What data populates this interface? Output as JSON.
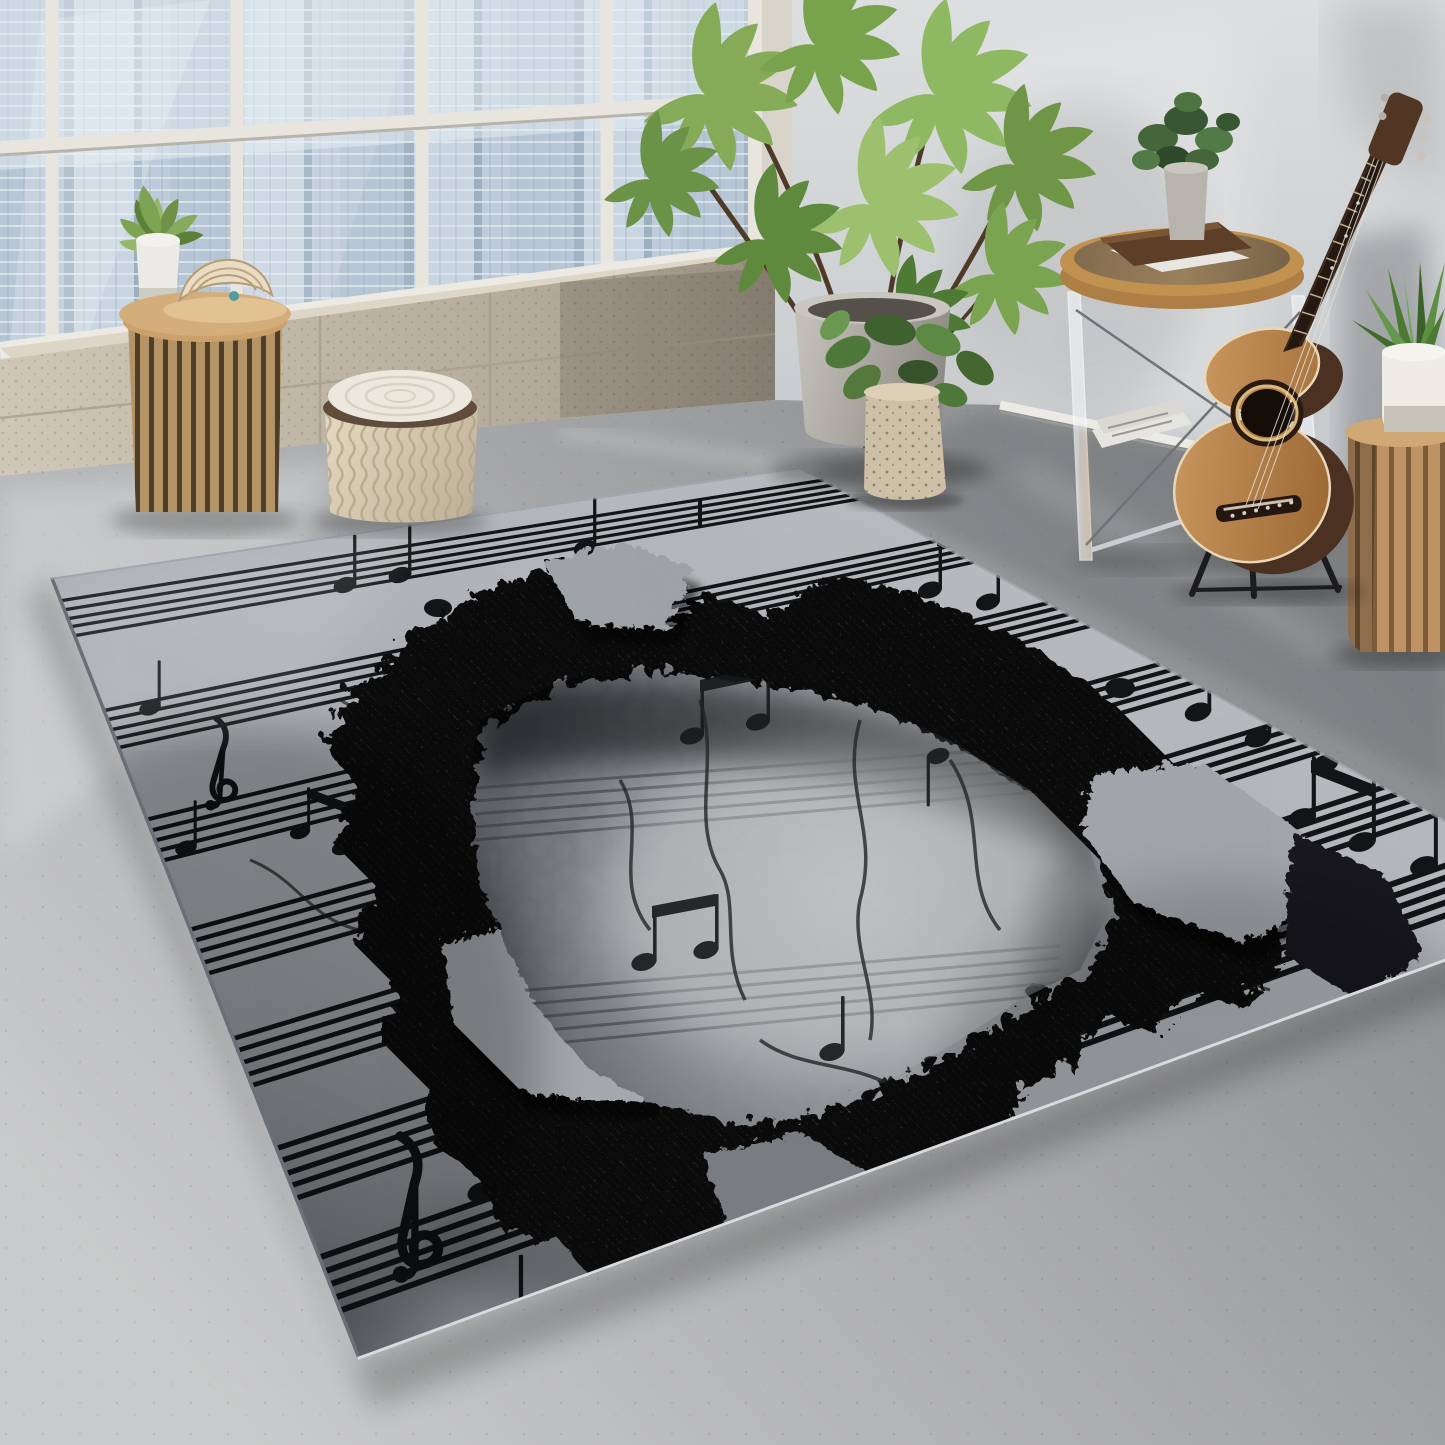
{
  "meta": {
    "description": "Interior photograph: loft room with large city-view window, concrete floor, and a black-and-grey 3D optical-illusion rug printed with sheet music and a cracked crater hole; acoustic guitar on a stand, plants, rattan side table, woven pouf, round glass-leg side table with books, wood slat stool.",
    "image_width": 1445,
    "image_height": 1445
  },
  "scene": {
    "objects": [
      {
        "id": "window-city-view",
        "label": "large paned window with city skyline"
      },
      {
        "id": "concrete-ledge",
        "label": "concrete block window ledge"
      },
      {
        "id": "windowsill-plant",
        "label": "small potted plant in white pot"
      },
      {
        "id": "rattan-side-table",
        "label": "rattan slatted side table"
      },
      {
        "id": "decor-sculpture",
        "label": "folded shell sculpture on wood slice"
      },
      {
        "id": "woven-pouf",
        "label": "cream woven pouf with cushion top"
      },
      {
        "id": "large-potted-plant",
        "label": "tall green plant in concrete pot"
      },
      {
        "id": "speckled-vase-plant",
        "label": "plant in speckled ceramic vase"
      },
      {
        "id": "console-table",
        "label": "round wood-top table with clear legs"
      },
      {
        "id": "book-stack",
        "label": "brown book on white papers"
      },
      {
        "id": "table-plant",
        "label": "small bushy plant on table"
      },
      {
        "id": "newspapers",
        "label": "newspapers under table"
      },
      {
        "id": "acoustic-guitar",
        "label": "acoustic guitar on black stand"
      },
      {
        "id": "wood-slat-stool",
        "label": "cylindrical wood slat stool"
      },
      {
        "id": "stool-plant",
        "label": "spiky plant in white pot on stool"
      },
      {
        "id": "music-rug",
        "label": "3D cracked music-sheet area rug"
      },
      {
        "id": "rug-crater",
        "label": "illusion crater with rocky rim"
      },
      {
        "id": "treble-clefs",
        "label": "treble clef motifs"
      },
      {
        "id": "concrete-floor",
        "label": "polished grey concrete floor"
      }
    ],
    "rug": {
      "style": "3D broken music sheet illusion",
      "motifs": [
        "staff lines",
        "quarter and eighth notes",
        "beamed note groups",
        "treble clefs",
        "cracked crater with rock rim"
      ]
    }
  },
  "colors": {
    "wall": "#d2d4d6",
    "floor": "#a6a7a9",
    "city_glass": "#c2cfdc",
    "frame_white": "#e8e5de",
    "ledge_concrete": "#c5bcab",
    "baseboard": "#eceae5",
    "rug_base": "#c6cad0",
    "rug_ink": "#16181a",
    "crater_dark": "#0e0f11",
    "rock_light": "#b9bec4",
    "pouf_cream": "#ece8de",
    "wood_light": "#d4ae7a",
    "pot_concrete": "#a9a5a0",
    "vase_speckled": "#cec0a7",
    "book_brown": "#5d3f27",
    "paper_white": "#e8e6e1",
    "guitar_top": "#bd8c54",
    "guitar_side": "#4a3122",
    "pot_white": "#efece6",
    "plant_green": "#76a14e"
  }
}
